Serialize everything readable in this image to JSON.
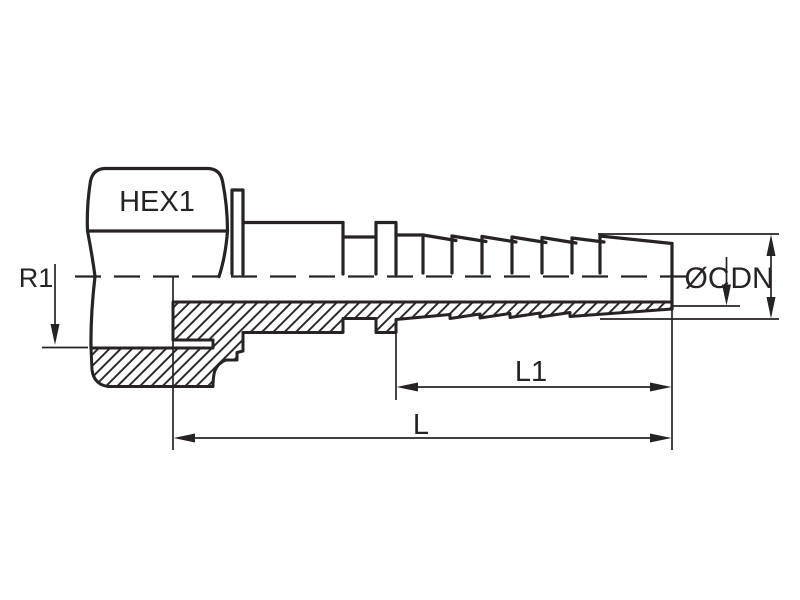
{
  "drawing": {
    "title": "hose-fitting-technical-drawing",
    "labels": {
      "hex": "HEX1",
      "radius": "R1",
      "diameter_c": "ØC",
      "diameter_dn": "DN",
      "length_l1": "L1",
      "length_l": "L"
    },
    "colors": {
      "line": "#272324",
      "background": "#ffffff"
    }
  }
}
